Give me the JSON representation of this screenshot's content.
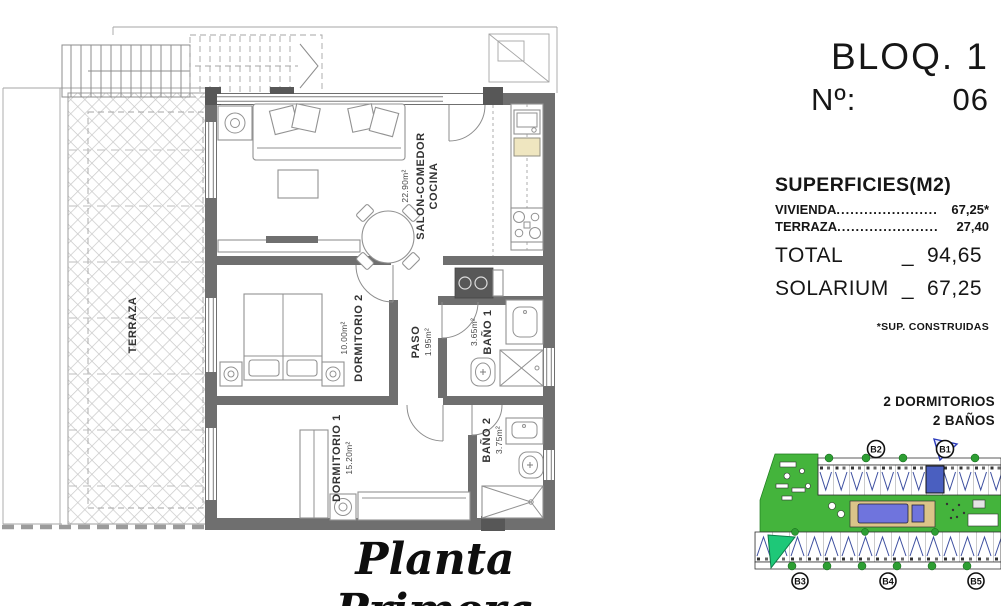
{
  "header": {
    "block": "BLOQ. 1",
    "no_label": "Nº:",
    "no_value": "06"
  },
  "surfaces": {
    "title": "SUPERFICIES(M2)",
    "items": [
      {
        "label": "VIVIENDA",
        "dots": "......................",
        "value": "67,25*"
      },
      {
        "label": "TERRAZA",
        "dots": "......................",
        "value": "27,40"
      }
    ],
    "total": {
      "label": "TOTAL",
      "sep": "_",
      "value": "94,65"
    },
    "solarium": {
      "label": "SOLARIUM",
      "sep": "_",
      "value": "67,25"
    },
    "footnote": "*SUP. CONSTRUIDAS"
  },
  "features": {
    "line1": "2 DORMITORIOS",
    "line2": "2 BAÑOS"
  },
  "plan": {
    "caption": "Planta Primera",
    "rooms": {
      "terraza": "TERRAZA",
      "salon_area": "22.90m²",
      "salon_name1": "SALON-COMEDOR",
      "salon_name2": "COCINA",
      "dorm2_area": "10.00m²",
      "dorm2_name": "DORMITORIO 2",
      "paso_name": "PASO",
      "paso_area": "1.95m²",
      "bano1_area": "3.65m²",
      "bano1_name": "BAÑO 1",
      "dorm1_name": "DORMITORIO 1",
      "dorm1_area": "15.20m²",
      "bano2_name": "BAÑO 2",
      "bano2_area": "3.75m²"
    }
  },
  "site_plan": {
    "badges": {
      "b1": "B1",
      "b2": "B2",
      "b3": "B3",
      "b4": "B4",
      "b5": "B5"
    },
    "colors": {
      "grass": "#44b43c",
      "pool": "#6f74dd",
      "deck": "#dbc489",
      "highlight": "#4a5fc0",
      "flag": "#1ec878",
      "tree": "#2e9e33"
    }
  }
}
